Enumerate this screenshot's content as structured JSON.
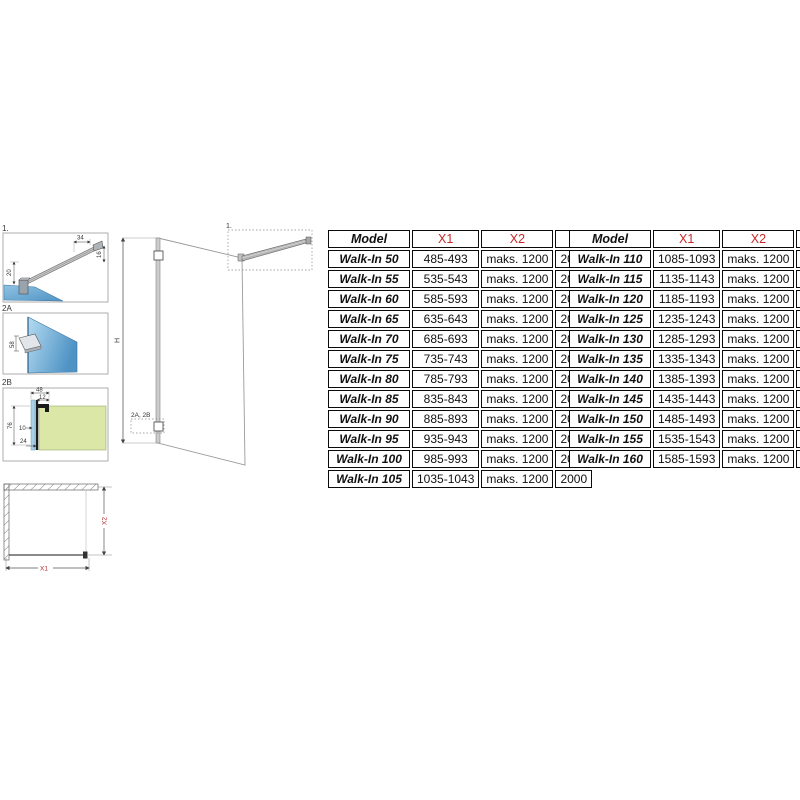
{
  "colors": {
    "accent_red": "#c7292b",
    "plan_dim_red": "#b22a2a",
    "glass_blue_dark": "#4f93c5",
    "glass_blue_light": "#b5dcf1",
    "wall_green": "#dbe7a6",
    "metal_gray": "#c4c4c4",
    "line_gray": "#999999"
  },
  "drawings": {
    "detail1": {
      "label": "1.",
      "dim_left": "20",
      "dim_top": "34",
      "dim_right": "16"
    },
    "detail2a": {
      "label": "2A",
      "dim_bracket": "58"
    },
    "detail2b": {
      "label": "2B",
      "dim_top": "48",
      "dim_top_inner": "12",
      "dim_left": "76",
      "dim_mid": "10",
      "dim_bottom": "24"
    },
    "elevation": {
      "height_label": "H",
      "callout_top": "1.",
      "callout_bottom": "2A, 2B"
    },
    "plan": {
      "width_label": "X1",
      "depth_label": "X2"
    }
  },
  "tables": {
    "left": {
      "headers": [
        "Model",
        "X1",
        "X2",
        "H"
      ],
      "red_columns": [
        1,
        2
      ],
      "rows": [
        [
          "Walk-In 50",
          "485-493",
          "maks. 1200",
          "2000"
        ],
        [
          "Walk-In 55",
          "535-543",
          "maks. 1200",
          "2000"
        ],
        [
          "Walk-In 60",
          "585-593",
          "maks. 1200",
          "2000"
        ],
        [
          "Walk-In 65",
          "635-643",
          "maks. 1200",
          "2000"
        ],
        [
          "Walk-In 70",
          "685-693",
          "maks. 1200",
          "2000"
        ],
        [
          "Walk-In 75",
          "735-743",
          "maks. 1200",
          "2000"
        ],
        [
          "Walk-In 80",
          "785-793",
          "maks. 1200",
          "2000"
        ],
        [
          "Walk-In 85",
          "835-843",
          "maks. 1200",
          "2000"
        ],
        [
          "Walk-In 90",
          "885-893",
          "maks. 1200",
          "2000"
        ],
        [
          "Walk-In 95",
          "935-943",
          "maks. 1200",
          "2000"
        ],
        [
          "Walk-In 100",
          "985-993",
          "maks. 1200",
          "2000"
        ],
        [
          "Walk-In 105",
          "1035-1043",
          "maks. 1200",
          "2000"
        ]
      ]
    },
    "right": {
      "headers": [
        "Model",
        "X1",
        "X2",
        "H"
      ],
      "red_columns": [
        1,
        2
      ],
      "rows": [
        [
          "Walk-In 110",
          "1085-1093",
          "maks. 1200",
          "2000"
        ],
        [
          "Walk-In 115",
          "1135-1143",
          "maks. 1200",
          "2000"
        ],
        [
          "Walk-In 120",
          "1185-1193",
          "maks. 1200",
          "2000"
        ],
        [
          "Walk-In 125",
          "1235-1243",
          "maks. 1200",
          "2000"
        ],
        [
          "Walk-In 130",
          "1285-1293",
          "maks. 1200",
          "2000"
        ],
        [
          "Walk-In 135",
          "1335-1343",
          "maks. 1200",
          "2000"
        ],
        [
          "Walk-In 140",
          "1385-1393",
          "maks. 1200",
          "2000"
        ],
        [
          "Walk-In 145",
          "1435-1443",
          "maks. 1200",
          "2000"
        ],
        [
          "Walk-In 150",
          "1485-1493",
          "maks. 1200",
          "2000"
        ],
        [
          "Walk-In 155",
          "1535-1543",
          "maks. 1200",
          "2000"
        ],
        [
          "Walk-In 160",
          "1585-1593",
          "maks. 1200",
          "2000"
        ]
      ]
    }
  }
}
